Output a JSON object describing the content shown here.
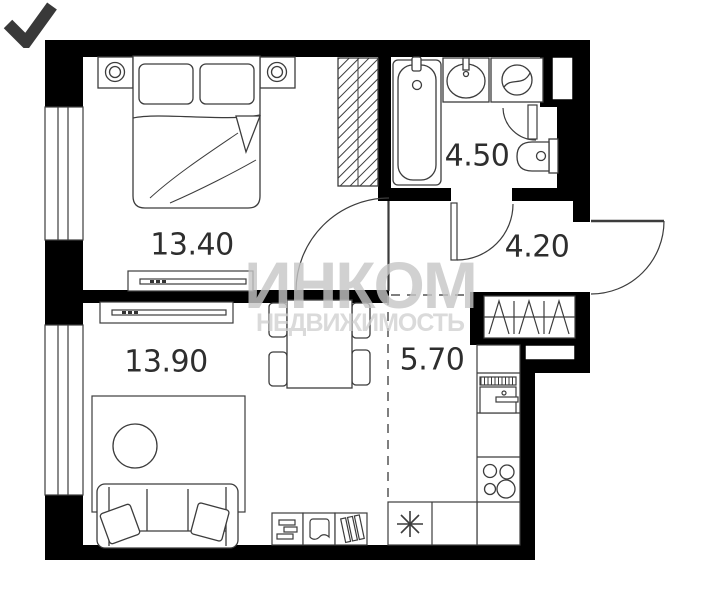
{
  "watermark": {
    "title": "ИНКОМ",
    "subtitle": "НЕДВИЖИМОСТЬ"
  },
  "rooms": {
    "bedroom": {
      "name": "bedroom",
      "area": "13.40"
    },
    "living_room": {
      "name": "living-room",
      "area": "13.90"
    },
    "bathroom": {
      "name": "bathroom",
      "area": "4.50"
    },
    "hallway": {
      "name": "hallway",
      "area": "4.20"
    },
    "kitchen": {
      "name": "kitchen",
      "area": "5.70"
    }
  },
  "colors": {
    "wall": "#000000",
    "line": "#3c3c3c",
    "label": "#2e2e2e",
    "watermark": "#c6c6c6",
    "watermark_check": "rgba(35,35,35,0.9)"
  }
}
